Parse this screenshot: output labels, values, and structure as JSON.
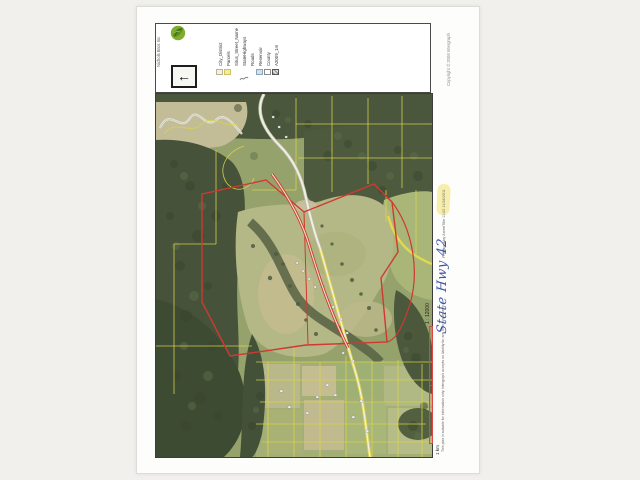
{
  "header": {
    "client_name": "Nichols Bros Inc",
    "logo": "green-globe-leaf-logo",
    "north_arrow_glyph": "←",
    "legend": {
      "items": [
        {
          "label": "City_District",
          "swatch": "cream-square"
        },
        {
          "label": "Parcels",
          "swatch": "yellow-square"
        },
        {
          "label": "Situs_Street_Name",
          "swatch": "none"
        },
        {
          "label": "StateHighways",
          "swatch": "squiggle-line"
        },
        {
          "label": "Roads",
          "swatch": "none"
        },
        {
          "label": "Reservoir",
          "swatch": "blue-square"
        },
        {
          "label": "County",
          "swatch": "white-square"
        },
        {
          "label": "A2009_1m",
          "swatch": "raster-checker"
        }
      ]
    }
  },
  "map": {
    "description": "Aerial orthophoto parcel map: yellow parcel boundaries, red highlighted parcels and route along State Hwy 42, river valley at top, forested hills and farm fields",
    "scale_ratio": "1 : 12000",
    "scale_bar_label": "1 km",
    "colors": {
      "parcel_line": "#d9d44a",
      "route_highlight": "#ce3a31",
      "forest_dark": "#46533a",
      "field_light": "#b4b786",
      "scale_bar_red": "#dd4743",
      "highlighter_yellow": "#f4eb9b",
      "handwriting_ink": "#3d55a8"
    }
  },
  "annotations": {
    "handwritten_note": "State Hwy 42"
  },
  "footer": {
    "produced_by": "Produced by AmeriTitle 11:02 11/28/2011",
    "copyright": "Copyright © 2008 Intergraph",
    "disclaimer": "This plan is suitable for information only. Intergraph accepts no liability for any error whatsoever."
  }
}
